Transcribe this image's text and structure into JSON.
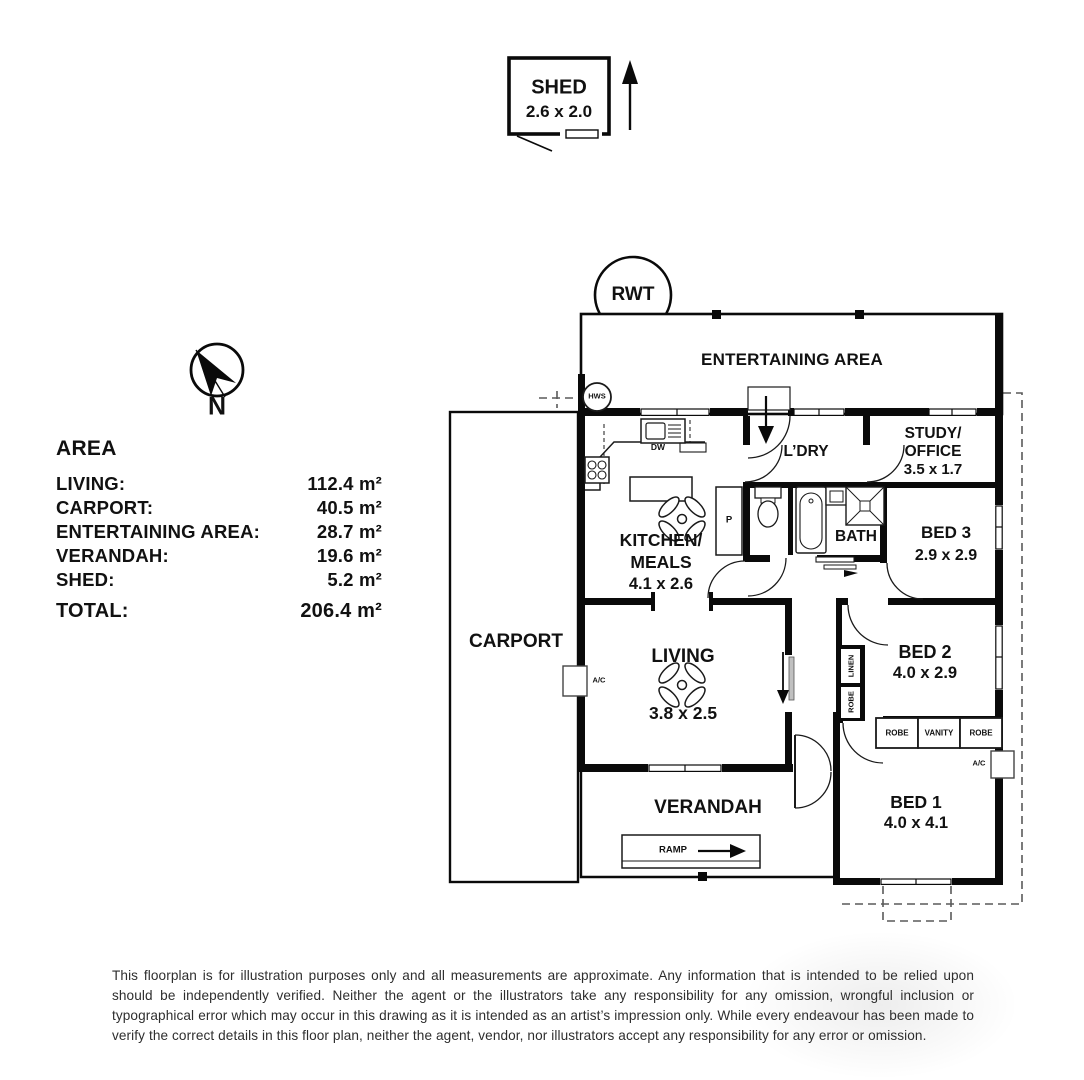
{
  "shed": {
    "name": "SHED",
    "dims": "2.6 x 2.0"
  },
  "rwt_label": "RWT",
  "hws_label": "HWS",
  "compass_label": "N",
  "legend": {
    "title": "AREA",
    "rows": [
      {
        "label": "LIVING:",
        "value": "112.4 m²"
      },
      {
        "label": "CARPORT:",
        "value": "40.5 m²"
      },
      {
        "label": "ENTERTAINING AREA:",
        "value": "28.7 m²"
      },
      {
        "label": "VERANDAH:",
        "value": "19.6 m²"
      },
      {
        "label": "SHED:",
        "value": "5.2 m²"
      }
    ],
    "total_label": "TOTAL:",
    "total_value": "206.4 m²"
  },
  "rooms": {
    "entertaining": "ENTERTAINING AREA",
    "carport": "CARPORT",
    "verandah": "VERANDAH",
    "kitchen": {
      "line1": "KITCHEN/",
      "line2": "MEALS",
      "dims": "4.1 x 2.6"
    },
    "ldry": "L’DRY",
    "study": {
      "line1": "STUDY/",
      "line2": "OFFICE",
      "dims": "3.5 x 1.7"
    },
    "bath": "BATH",
    "bed3": {
      "name": "BED 3",
      "dims": "2.9 x 2.9"
    },
    "bed2": {
      "name": "BED 2",
      "dims": "4.0 x 2.9"
    },
    "bed1": {
      "name": "BED 1",
      "dims": "4.0 x 4.1"
    },
    "living": {
      "name": "LIVING",
      "dims": "3.8 x 2.5"
    }
  },
  "fixtures": {
    "pantry": "P",
    "dw": "DW",
    "ramp": "RAMP",
    "ac": "A/C",
    "linen": "LINEN",
    "robe": "ROBE",
    "strip": [
      "ROBE",
      "VANITY",
      "ROBE"
    ]
  },
  "disclaimer": "This floorplan is for illustration purposes only and all measurements are approximate. Any information that is intended to be relied upon should be independently verified. Neither the agent or the illustrators take any responsibility for any omission, wrongful inclusion or typographical error which may occur in this drawing as it is intended as an artist’s impression only. While every endeavour has been made to verify the correct details in this floor plan, neither the agent, vendor, nor illustrators accept any responsibility for any error or omission."
}
